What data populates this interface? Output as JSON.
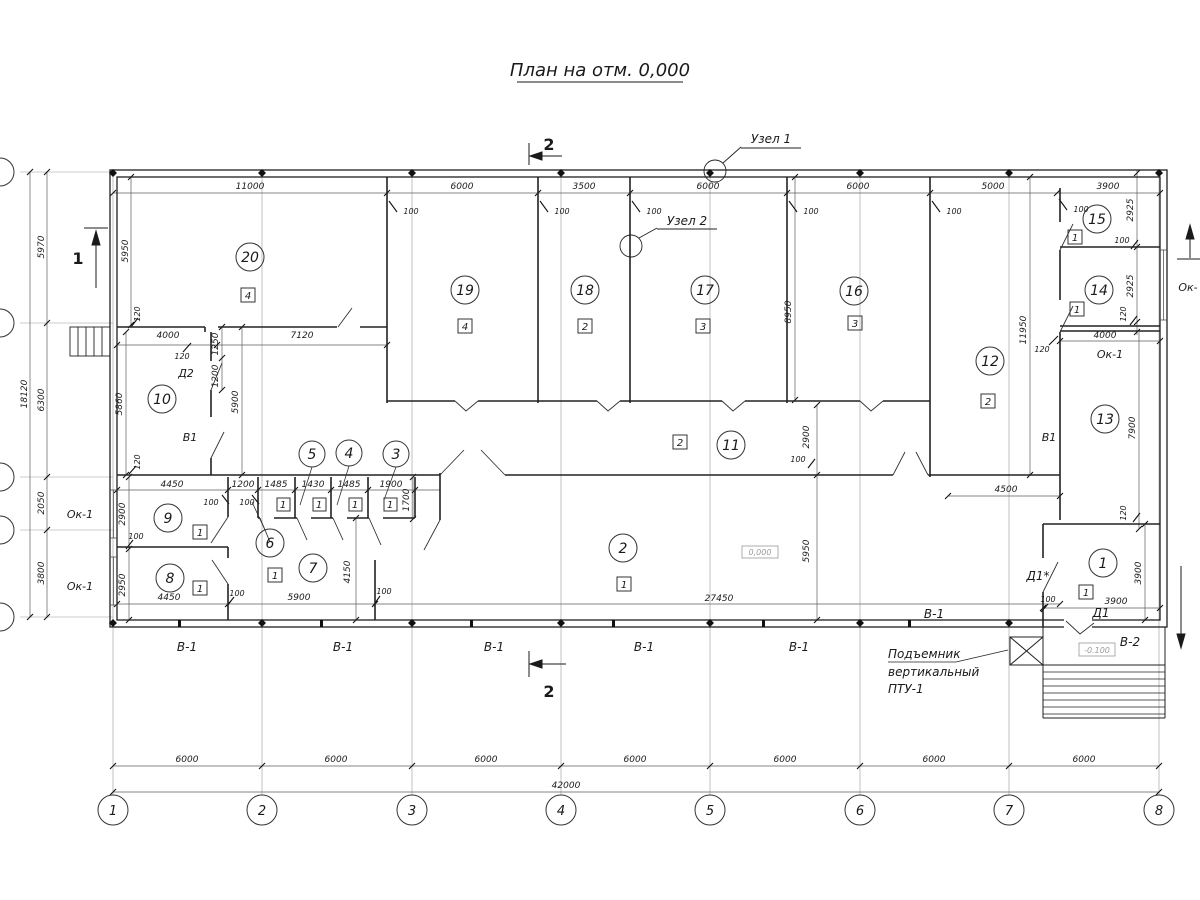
{
  "title": "План на отм. 0,000",
  "section_marks": {
    "top": "2",
    "bottom": "2",
    "left": "1"
  },
  "callouts": {
    "uzel1": "Узел 1",
    "uzel2": "Узел 2"
  },
  "lift": {
    "line1": "Подъемник",
    "line2": "вертикальный",
    "line3": "ПТУ-1"
  },
  "elevations": {
    "ground": "0,000",
    "entrance": "-0.100"
  },
  "axes": {
    "numbers": [
      "1",
      "2",
      "3",
      "4",
      "5",
      "6",
      "7",
      "8"
    ],
    "bays": [
      "6000",
      "6000",
      "6000",
      "6000",
      "6000",
      "6000",
      "6000"
    ],
    "overall": "42000",
    "left_chain": [
      "5970",
      "6300",
      "2050",
      "3800"
    ],
    "left_overall": "18120"
  },
  "top_dims": [
    "11000",
    "6000",
    "3500",
    "6000",
    "6000",
    "5000",
    "3900"
  ],
  "rooms": [
    {
      "n": "1",
      "type": "1"
    },
    {
      "n": "2",
      "type": "1"
    },
    {
      "n": "3"
    },
    {
      "n": "4"
    },
    {
      "n": "5"
    },
    {
      "n": "6"
    },
    {
      "n": "7",
      "type": "1"
    },
    {
      "n": "8",
      "type": "1"
    },
    {
      "n": "9",
      "type": "1"
    },
    {
      "n": "10"
    },
    {
      "n": "11",
      "type": "2"
    },
    {
      "n": "12",
      "type": "2"
    },
    {
      "n": "13"
    },
    {
      "n": "14",
      "type": "1"
    },
    {
      "n": "15",
      "type": "1"
    },
    {
      "n": "16",
      "type": "3"
    },
    {
      "n": "17",
      "type": "3"
    },
    {
      "n": "18",
      "type": "2"
    },
    {
      "n": "19",
      "type": "4"
    },
    {
      "n": "20",
      "type": "4"
    }
  ],
  "stall_types": [
    "1",
    "1",
    "1",
    "1"
  ],
  "dims": {
    "w100": "100",
    "w120": "120",
    "room20_h": "5950",
    "room20_left": "4000",
    "room20_right": "7120",
    "d2_upper": "1250",
    "d2_lower": "1200",
    "room10_h": "5860",
    "hall10_h": "5900",
    "room16_h": "8950",
    "wall_12": "11950",
    "r15_h": "2925",
    "r14_h": "2925",
    "ok_right_w": "4000",
    "r13_h": "7900",
    "corr_h": "2900",
    "room2_h": "5950",
    "room2_w": "27450",
    "hall_e": "4500",
    "row9_w": "4450",
    "gap1200": "1200",
    "st1": "1485",
    "st2": "1430",
    "st3": "1485",
    "st4": "1900",
    "st_h": "1700",
    "room9_h": "2900",
    "room8_h": "2950",
    "room8_w": "4450",
    "rooms67_w": "5900",
    "room7_h": "4150",
    "room1_w": "3900",
    "room1_h": "3900"
  },
  "labels": {
    "d2": "Д2",
    "v1": "В1",
    "ok1": "Ок-1",
    "ok_cut": "Ок-",
    "b1": "В-1",
    "b2": "В-2",
    "d1": "Д1",
    "d1m": "Д1*"
  }
}
